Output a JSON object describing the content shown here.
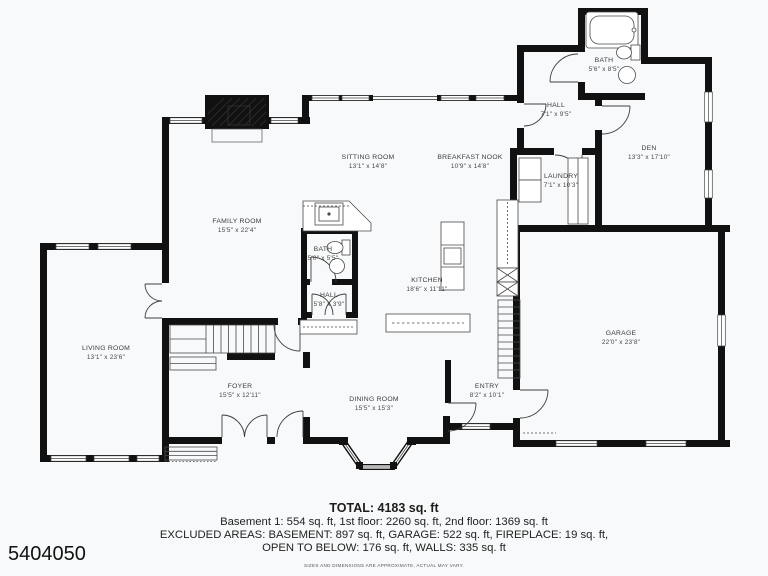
{
  "colors": {
    "wall": "#111111",
    "background": "#f8f9fa",
    "thin_line": "#454545"
  },
  "rooms": [
    {
      "name": "SITTING ROOM",
      "dims": "13'1\" x 14'8\""
    },
    {
      "name": "BREAKFAST NOOK",
      "dims": "10'9\" x 14'8\""
    },
    {
      "name": "HALL",
      "dims": "7'1\" x 9'5\""
    },
    {
      "name": "BATH",
      "dims": "5'6\" x 8'5\""
    },
    {
      "name": "DEN",
      "dims": "13'3\" x 17'10\""
    },
    {
      "name": "LAUNDRY",
      "dims": "7'1\" x 10'3\""
    },
    {
      "name": "FAMILY ROOM",
      "dims": "15'5\" x 22'4\""
    },
    {
      "name": "BATH",
      "dims": "5'0\" x 5'5\""
    },
    {
      "name": "KITCHEN",
      "dims": "18'6\" x 11'11\""
    },
    {
      "name": "HALL",
      "dims": "5'8\" x 3'9\""
    },
    {
      "name": "LIVING ROOM",
      "dims": "13'1\" x 23'6\""
    },
    {
      "name": "GARAGE",
      "dims": "22'0\" x 23'8\""
    },
    {
      "name": "FOYER",
      "dims": "15'5\" x 12'11\""
    },
    {
      "name": "DINING ROOM",
      "dims": "15'5\" x 15'3\""
    },
    {
      "name": "ENTRY",
      "dims": "8'2\" x 10'1\""
    }
  ],
  "footer": {
    "total": "TOTAL: 4183 sq. ft",
    "line1": "Basement 1: 554 sq. ft, 1st floor: 2260 sq. ft, 2nd floor: 1369 sq. ft",
    "line2": "EXCLUDED AREAS: BASEMENT: 897 sq. ft, GARAGE: 522 sq. ft, FIREPLACE: 19 sq. ft,",
    "line3": "OPEN TO BELOW: 176 sq. ft, WALLS: 335 sq. ft",
    "disclaimer": "SIZES AND DIMENSIONS ARE APPROXIMATE, ACTUAL MAY VARY."
  },
  "listing_id": "5404050"
}
